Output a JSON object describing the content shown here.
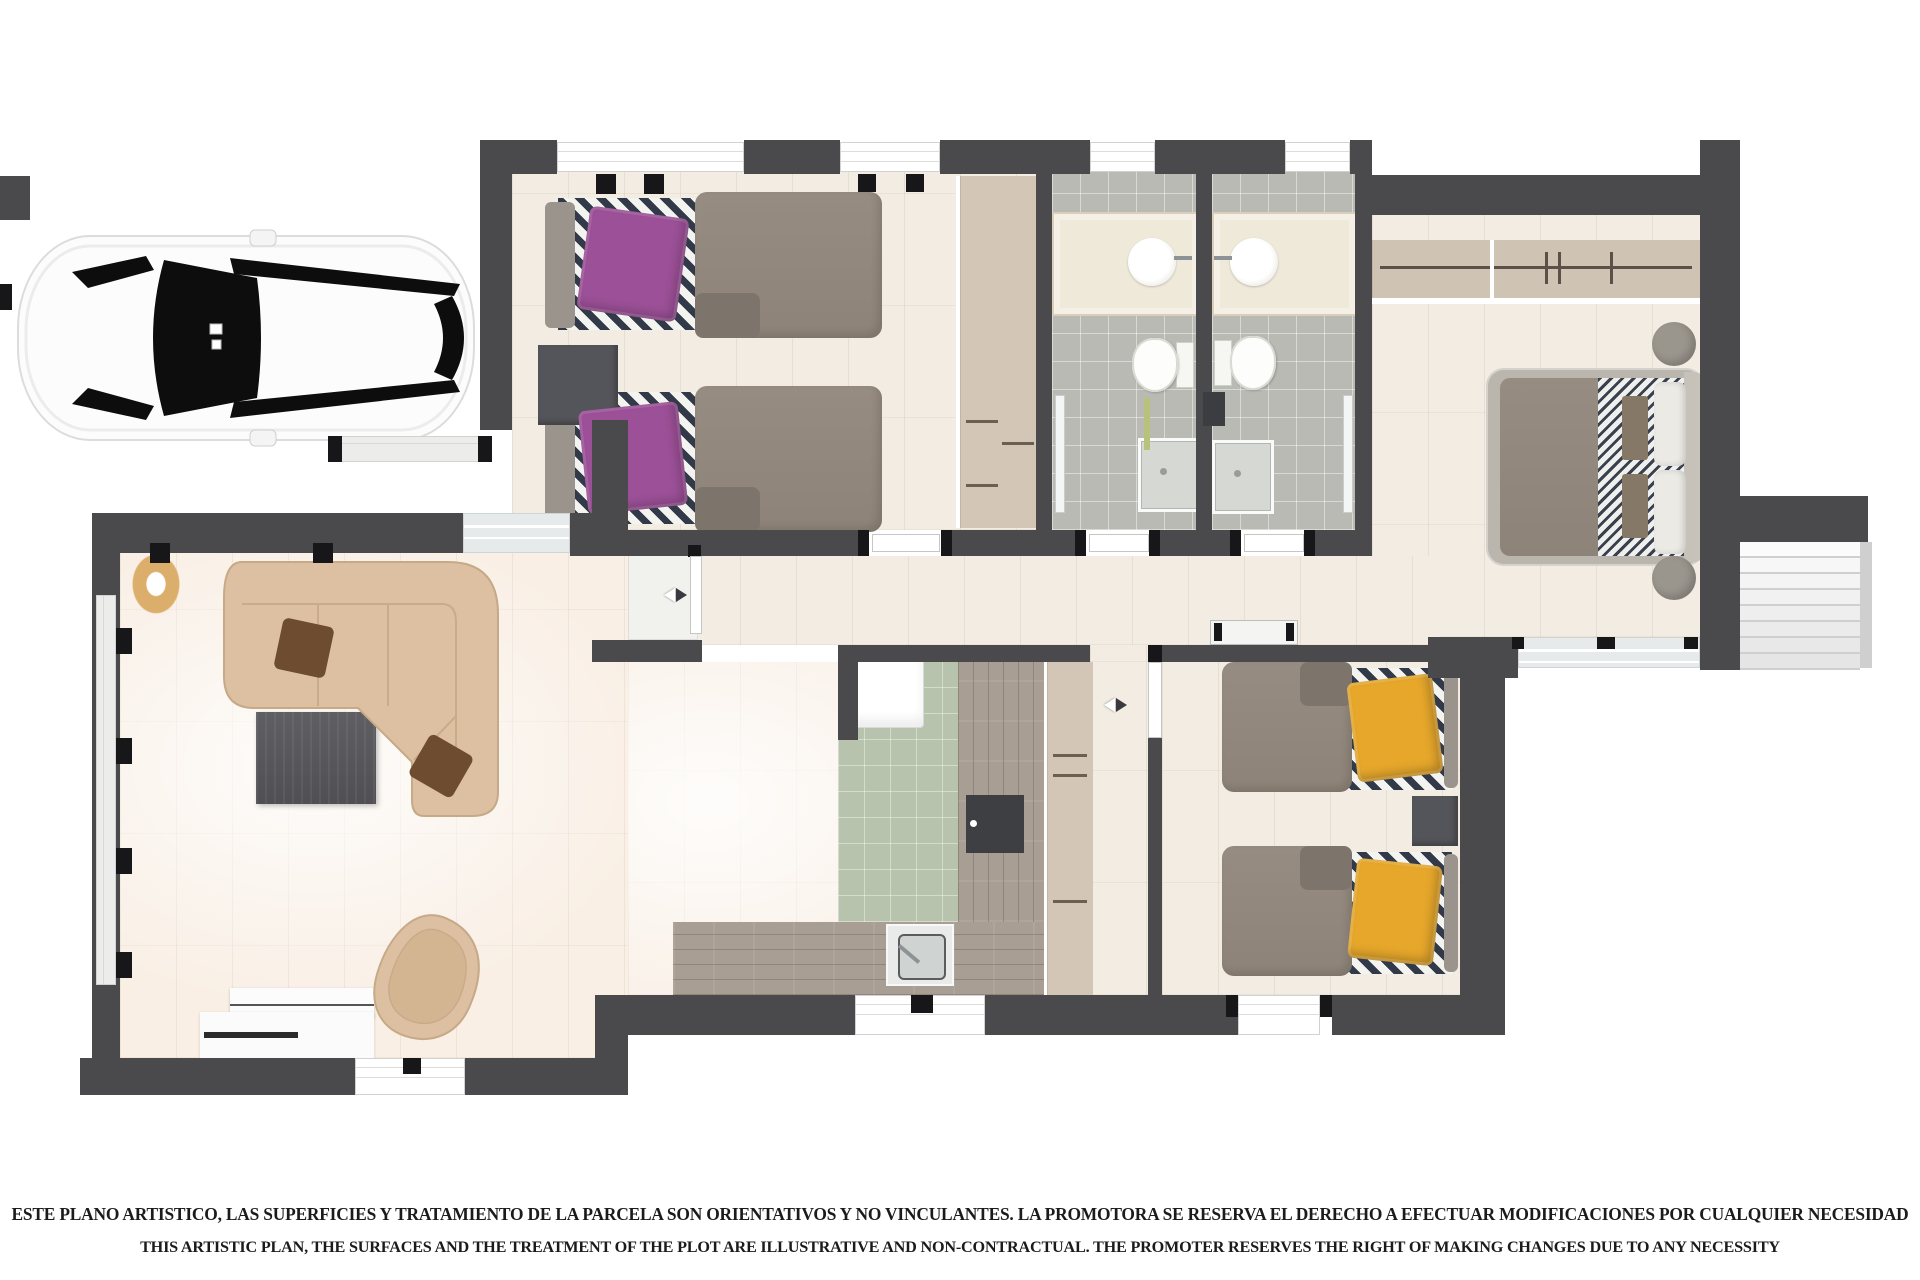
{
  "disclaimer": {
    "line1": "ESTE PLANO ARTISTICO, LAS SUPERFICIES Y TRATAMIENTO DE LA PARCELA SON ORIENTATIVOS Y NO VINCULANTES. LA PROMOTORA SE RESERVA EL DERECHO A EFECTUAR MODIFICACIONES POR CUALQUIER NECESIDAD",
    "line2": "THIS ARTISTIC PLAN, THE SURFACES AND THE TREATMENT OF THE PLOT ARE ILLUSTRATIVE AND NON-CONTRACTUAL. THE PROMOTER RESERVES THE RIGHT OF MAKING CHANGES DUE TO ANY NECESSITY"
  },
  "colors": {
    "wall": "#4a4a4d",
    "floor": "#f3ece2",
    "living": "#f9efe5",
    "bathTile": "#b8bab3",
    "kitchenTile": "#b7c3ac",
    "wood": "#a89e93",
    "wardrobe": "#d3c6b6",
    "sofa": "#dcc0a1",
    "pillowPurple": "#9c5097",
    "pillowYellow": "#e6a72b",
    "stripeDark": "#323a49",
    "duvetGrey": "#8d8378",
    "furnitureDark": "#54555a"
  }
}
